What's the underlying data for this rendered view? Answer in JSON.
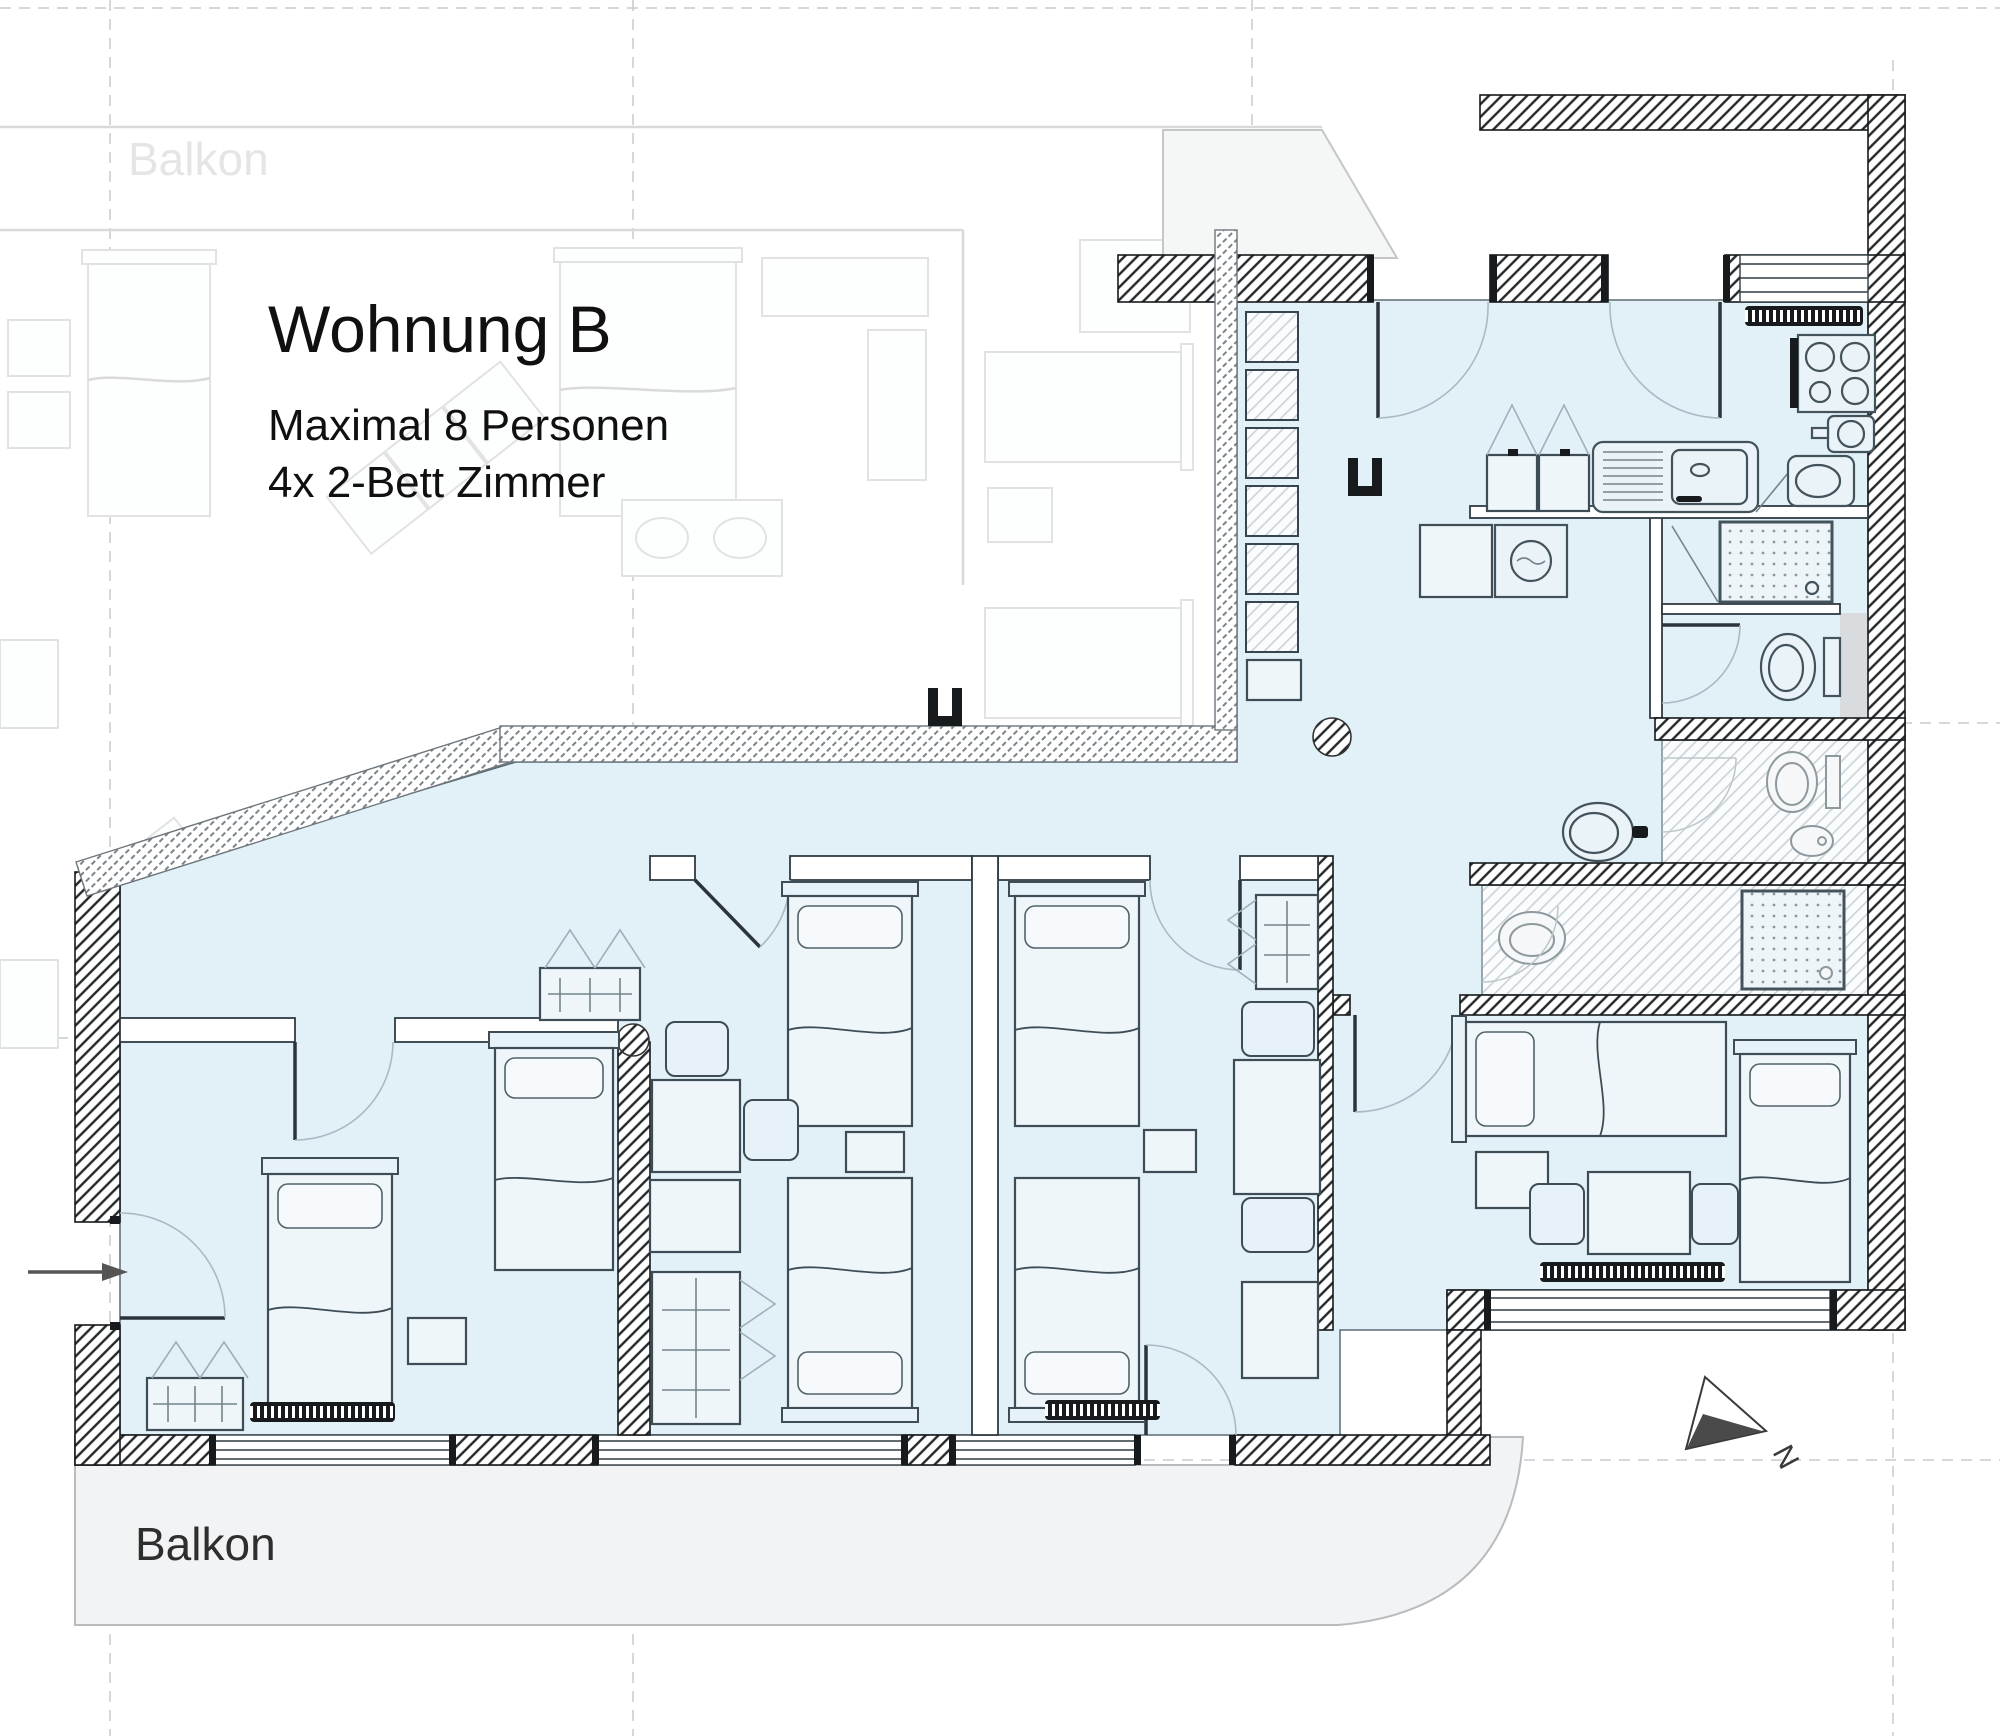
{
  "title_block": {
    "name": "Wohnung B",
    "capacity": "Maximal 8 Personen",
    "rooms": "4x 2-Bett Zimmer"
  },
  "labels": {
    "balcony_top": "Balkon",
    "balcony_bottom": "Balkon",
    "north_letter": "N"
  },
  "colors": {
    "apartment_fill": "#e2f1f8",
    "wall_black": "#16191b",
    "balcony_fill": "#f2f3f4",
    "faded_neighbor": "#e2e2e2",
    "hatch_light": "#c9d3d8"
  },
  "icons": {
    "north_arrow": "compass-north-arrow",
    "entry_arrow": "entrance-direction-arrow"
  }
}
